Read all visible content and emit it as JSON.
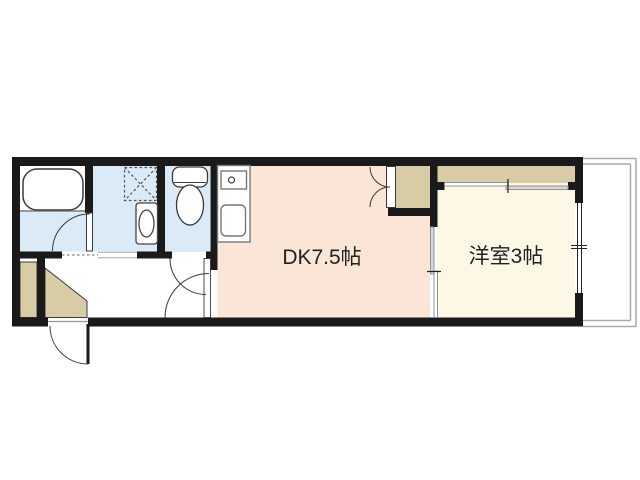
{
  "plan": {
    "type": "apartment-floor-plan",
    "rooms": {
      "dk": {
        "label": "DK7.5帖",
        "floor_color": "#fae5d6"
      },
      "western_room": {
        "label": "洋室3帖",
        "floor_color": "#fcf8e5"
      },
      "bathroom": {
        "label": "",
        "floor_color": "#ffffff"
      },
      "washroom": {
        "label": "",
        "floor_color": "#dbeaf7"
      },
      "toilet_room": {
        "label": "",
        "floor_color": "#dbeaf7"
      },
      "hallway": {
        "label": "",
        "floor_color": "#ffffff"
      },
      "balcony": {
        "label": "",
        "floor_color": "#ffffff"
      }
    },
    "fixtures": [
      "bathtub",
      "washing-machine-pan",
      "washbasin",
      "toilet",
      "kitchen-counter",
      "stove-burner",
      "kitchen-sink",
      "shoe-cabinet",
      "shoe-box",
      "dk-closet",
      "western-closet"
    ],
    "doors": [
      "entrance-door",
      "bathroom-door",
      "toilet-door",
      "dk-door",
      "dk-closet-double-doors",
      "western-closet-sliding-door",
      "dk-western-sliding-door"
    ],
    "colors": {
      "wall": "#1a1a1a",
      "wet_floor": "#dbeaf7",
      "dk_floor": "#fae5d6",
      "western_floor": "#fcf8e5",
      "closet": "#d8cca6",
      "fixture_stroke": "#3a3a3a",
      "thin_line": "#999999",
      "slider_panel": "#d8d8d8",
      "balcony_line": "#a9a9a9",
      "label_text": "#222222",
      "background": "#ffffff"
    }
  }
}
